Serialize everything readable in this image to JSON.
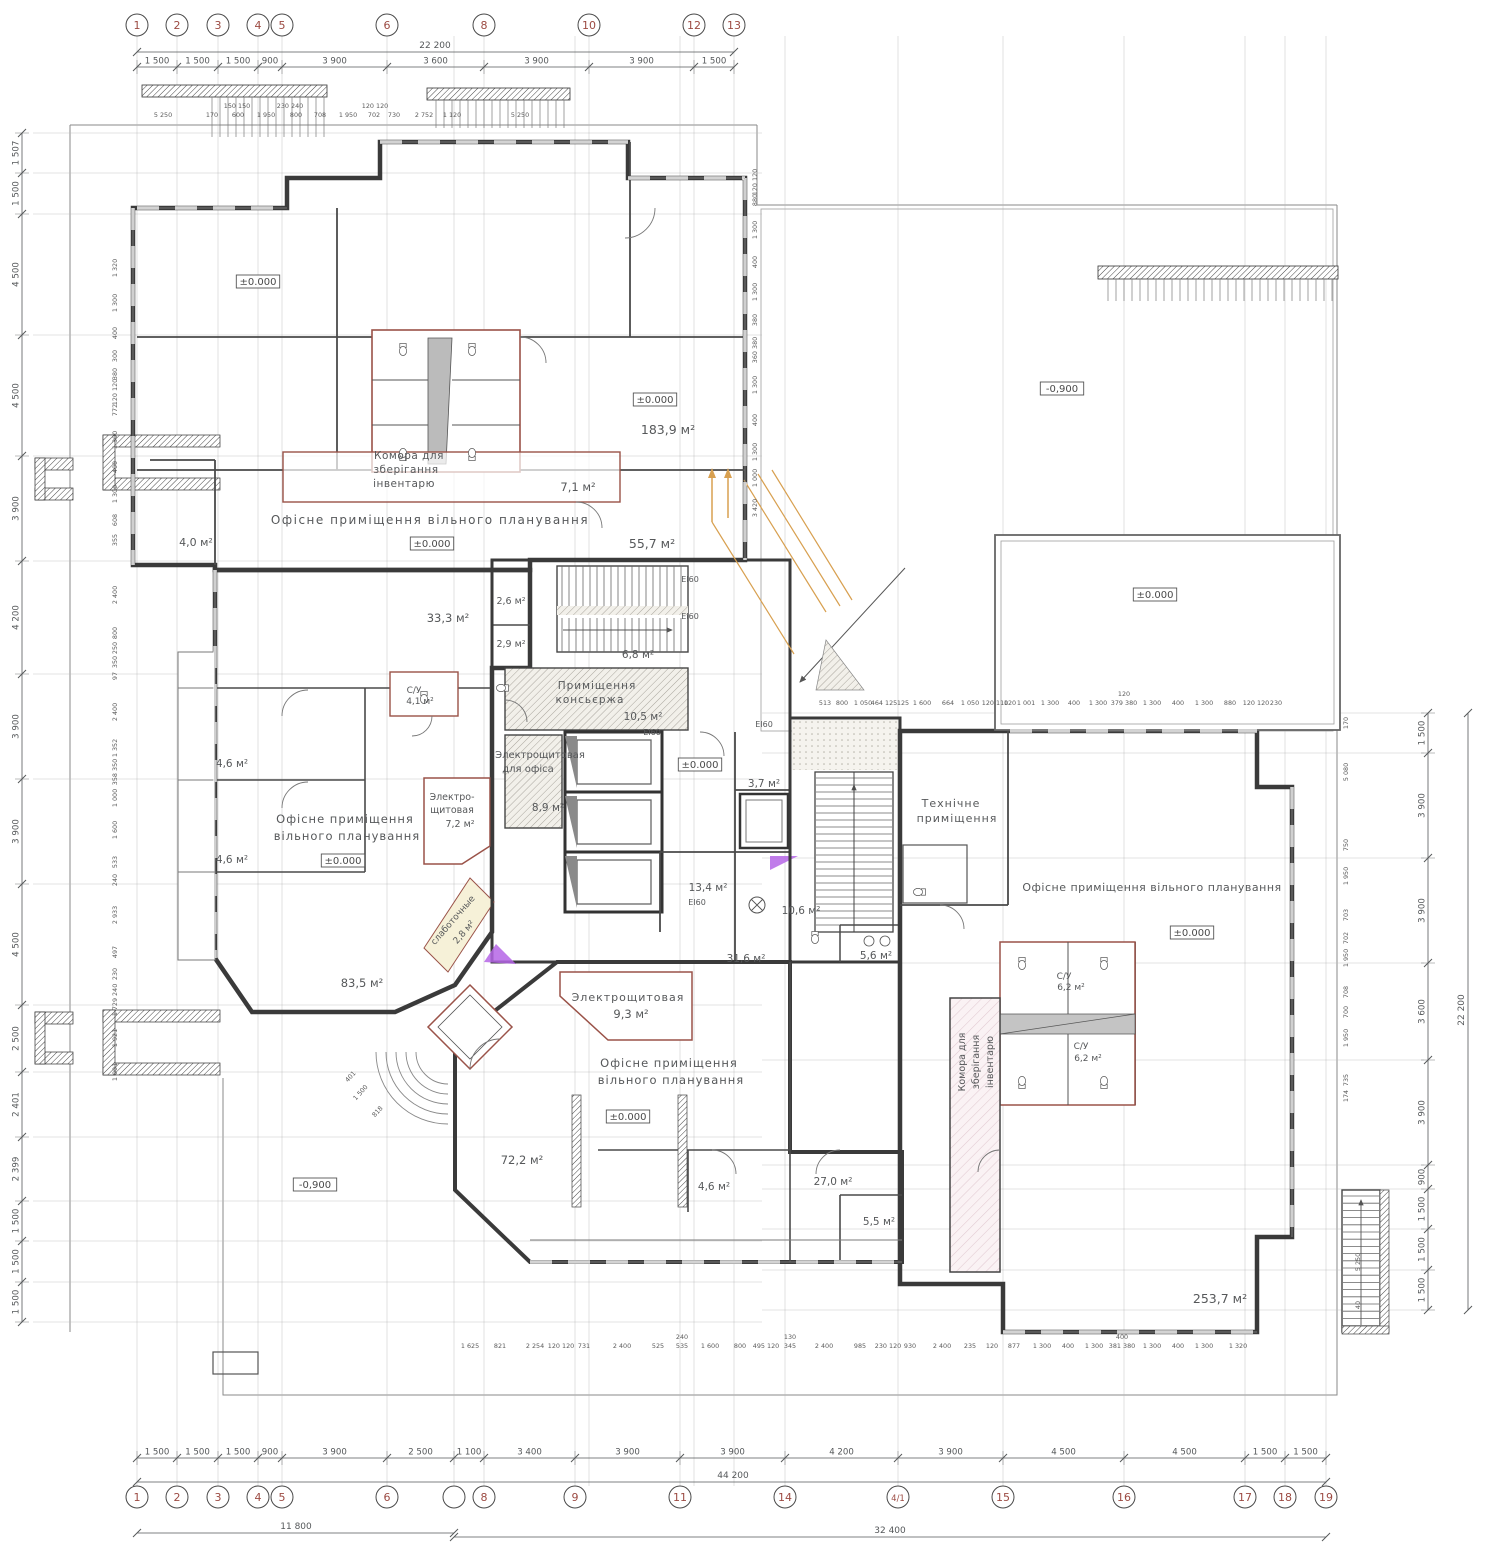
{
  "meta": {
    "title": "Ground floor plan — free-plan office building",
    "type": "architectural-floor-plan",
    "units": "mm"
  },
  "colors": {
    "wall": "#3a3a3a",
    "partition": "#9a5248",
    "dim": "#55585a",
    "tiny": "#5a5a5a",
    "axis_number": "#9c4a42",
    "mint": "#eef6f0",
    "cyan": "#ddf2f4",
    "lavender": "#eff0f9",
    "pink": "#faf2f4",
    "accent_orange": "#d8a050",
    "accent_purple": "#b565e6"
  },
  "dimensions": {
    "top_overall": "22 200",
    "bottom_overall": "44 200",
    "bottom_span_left": "11 800",
    "bottom_span_right": "32 400",
    "right_overall": "22 200"
  },
  "axes": {
    "top": {
      "cy": 25,
      "r": 11,
      "items": [
        [
          137,
          "1"
        ],
        [
          177,
          "2"
        ],
        [
          218,
          "3"
        ],
        [
          258,
          "4"
        ],
        [
          282,
          "5"
        ],
        [
          387,
          "6"
        ],
        [
          484,
          "8"
        ],
        [
          589,
          "10"
        ],
        [
          694,
          "12"
        ],
        [
          734,
          "13"
        ]
      ]
    },
    "bottom": {
      "cy": 1497,
      "r": 11,
      "items": [
        [
          137,
          "1"
        ],
        [
          177,
          "2"
        ],
        [
          218,
          "3"
        ],
        [
          258,
          "4"
        ],
        [
          282,
          "5"
        ],
        [
          387,
          "6"
        ],
        [
          454,
          ""
        ],
        [
          484,
          "8"
        ],
        [
          575,
          "9"
        ],
        [
          680,
          "11"
        ],
        [
          785,
          "14"
        ],
        [
          898,
          "4/1"
        ],
        [
          1003,
          "15"
        ],
        [
          1124,
          "16"
        ],
        [
          1245,
          "17"
        ],
        [
          1285,
          "18"
        ],
        [
          1326,
          "19"
        ]
      ]
    }
  },
  "grid": {
    "vx": [
      137,
      177,
      218,
      258,
      282,
      387,
      454,
      484,
      575,
      589,
      680,
      694,
      734,
      785,
      898,
      1003,
      1124,
      1245,
      1285,
      1326
    ],
    "hyl": [
      133,
      173,
      214,
      335,
      456,
      561,
      674,
      779,
      884,
      1005,
      1072,
      1137,
      1201,
      1241,
      1282,
      1322
    ],
    "hyr": [
      713,
      753,
      858,
      963,
      1060,
      1165,
      1189,
      1229,
      1270,
      1310
    ]
  },
  "chains": [
    {
      "name": "top-segments",
      "dir": "h",
      "pos": 67,
      "bounds": [
        137,
        177,
        218,
        258,
        282,
        387,
        484,
        589,
        694,
        734
      ],
      "labels": [
        "1 500",
        "1 500",
        "1 500",
        "900",
        "3 900",
        "3 600",
        "3 900",
        "3 900",
        "1 500"
      ]
    },
    {
      "name": "bottom-segments",
      "dir": "h",
      "pos": 1458,
      "bounds": [
        137,
        177,
        218,
        258,
        282,
        387,
        454,
        484,
        575,
        680,
        785,
        898,
        1003,
        1124,
        1245,
        1285,
        1326
      ],
      "labels": [
        "1 500",
        "1 500",
        "1 500",
        "900",
        "3 900",
        "2 500",
        "1 100",
        "3 400",
        "3 900",
        "3 900",
        "4 200",
        "3 900",
        "4 500",
        "4 500",
        "1 500",
        "1 500"
      ]
    },
    {
      "name": "left-segments",
      "dir": "v",
      "pos": 22,
      "bounds": [
        133,
        173,
        214,
        335,
        456,
        561,
        674,
        779,
        884,
        1005,
        1072,
        1137,
        1201,
        1241,
        1282,
        1322
      ],
      "labels": [
        "1 507",
        "1 500",
        "4 500",
        "4 500",
        "3 900",
        "4 200",
        "3 900",
        "3 900",
        "4 500",
        "2 500",
        "2 401",
        "2 399",
        "1 500",
        "1 500",
        "1 500"
      ]
    },
    {
      "name": "right-segments",
      "dir": "v",
      "pos": 1428,
      "bounds": [
        713,
        753,
        858,
        963,
        1060,
        1165,
        1189,
        1229,
        1270,
        1310
      ],
      "labels": [
        "1 500",
        "3 900",
        "3 900",
        "3 600",
        "3 900",
        "900",
        "1 500",
        "1 500",
        "1 500"
      ]
    }
  ],
  "overall_lines": [
    {
      "dir": "h",
      "pos": 52,
      "from": 137,
      "to": 734
    },
    {
      "dir": "h",
      "pos": 1482,
      "from": 137,
      "to": 1326
    },
    {
      "dir": "h",
      "pos": 1533,
      "from": 137,
      "to": 454
    },
    {
      "dir": "h",
      "pos": 1537,
      "from": 454,
      "to": 1326
    },
    {
      "dir": "v",
      "pos": 1468,
      "from": 713,
      "to": 1310
    }
  ],
  "tiny_dims": [
    [
      163,
      117,
      "5 250"
    ],
    [
      212,
      117,
      "170"
    ],
    [
      238,
      117,
      "600"
    ],
    [
      266,
      117,
      "1 950"
    ],
    [
      296,
      117,
      "800"
    ],
    [
      320,
      117,
      "708"
    ],
    [
      348,
      117,
      "1 950"
    ],
    [
      374,
      117,
      "702"
    ],
    [
      394,
      117,
      "730"
    ],
    [
      424,
      117,
      "2 752"
    ],
    [
      452,
      117,
      "1 120"
    ],
    [
      520,
      117,
      "5 250"
    ],
    [
      237,
      108,
      "150 150"
    ],
    [
      290,
      108,
      "230 240"
    ],
    [
      375,
      108,
      "120 120"
    ],
    [
      825,
      705,
      "513"
    ],
    [
      842,
      705,
      "800"
    ],
    [
      863,
      705,
      "1 050"
    ],
    [
      884,
      705,
      "464 125"
    ],
    [
      903,
      705,
      "125"
    ],
    [
      922,
      705,
      "1 600"
    ],
    [
      948,
      705,
      "664"
    ],
    [
      970,
      705,
      "1 050"
    ],
    [
      995,
      705,
      "120 110"
    ],
    [
      1010,
      705,
      "120"
    ],
    [
      1026,
      705,
      "1 001"
    ],
    [
      1050,
      705,
      "1 300"
    ],
    [
      1074,
      705,
      "400"
    ],
    [
      1098,
      705,
      "1 300"
    ],
    [
      1124,
      705,
      "379 380"
    ],
    [
      1152,
      705,
      "1 300"
    ],
    [
      1178,
      705,
      "400"
    ],
    [
      1204,
      705,
      "1 300"
    ],
    [
      1230,
      705,
      "880"
    ],
    [
      1256,
      705,
      "120 120"
    ],
    [
      1276,
      705,
      "230"
    ],
    [
      1124,
      696,
      "120"
    ],
    [
      470,
      1348,
      "1 625"
    ],
    [
      500,
      1348,
      "821"
    ],
    [
      535,
      1348,
      "2 254"
    ],
    [
      561,
      1348,
      "120 120"
    ],
    [
      584,
      1348,
      "731"
    ],
    [
      622,
      1348,
      "2 400"
    ],
    [
      658,
      1348,
      "525"
    ],
    [
      682,
      1348,
      "535"
    ],
    [
      682,
      1339,
      "240"
    ],
    [
      710,
      1348,
      "1 600"
    ],
    [
      740,
      1348,
      "800"
    ],
    [
      766,
      1348,
      "495 120"
    ],
    [
      790,
      1348,
      "345"
    ],
    [
      790,
      1339,
      "130"
    ],
    [
      824,
      1348,
      "2 400"
    ],
    [
      860,
      1348,
      "985"
    ],
    [
      888,
      1348,
      "230 120"
    ],
    [
      910,
      1348,
      "930"
    ],
    [
      942,
      1348,
      "2 400"
    ],
    [
      970,
      1348,
      "235"
    ],
    [
      992,
      1348,
      "120"
    ],
    [
      1014,
      1348,
      "877"
    ],
    [
      1042,
      1348,
      "1 300"
    ],
    [
      1068,
      1348,
      "400"
    ],
    [
      1094,
      1348,
      "1 300"
    ],
    [
      1122,
      1348,
      "381 380"
    ],
    [
      1122,
      1339,
      "400"
    ],
    [
      1152,
      1348,
      "1 300"
    ],
    [
      1178,
      1348,
      "400"
    ],
    [
      1204,
      1348,
      "1 300"
    ],
    [
      1238,
      1348,
      "1 320"
    ],
    [
      117,
      268,
      "1 320",
      -90
    ],
    [
      117,
      303,
      "1 300",
      -90
    ],
    [
      117,
      333,
      "400",
      -90
    ],
    [
      117,
      356,
      "300",
      -90
    ],
    [
      117,
      374,
      "380",
      -90
    ],
    [
      117,
      392,
      "120 120",
      -90
    ],
    [
      117,
      410,
      "772",
      -90
    ],
    [
      117,
      440,
      "1 300",
      -90
    ],
    [
      117,
      467,
      "400",
      -90
    ],
    [
      117,
      494,
      "1 300",
      -90
    ],
    [
      117,
      520,
      "608",
      -90
    ],
    [
      117,
      540,
      "355",
      -90
    ],
    [
      117,
      595,
      "2 400",
      -90
    ],
    [
      117,
      633,
      "800",
      -90
    ],
    [
      117,
      648,
      "250",
      -90
    ],
    [
      117,
      662,
      "350",
      -90
    ],
    [
      117,
      676,
      "97",
      -90
    ],
    [
      117,
      712,
      "2 400",
      -90
    ],
    [
      117,
      748,
      "1 352",
      -90
    ],
    [
      117,
      772,
      "358 350",
      -90
    ],
    [
      117,
      798,
      "1 000",
      -90
    ],
    [
      117,
      830,
      "1 600",
      -90
    ],
    [
      117,
      862,
      "533",
      -90
    ],
    [
      117,
      880,
      "240",
      -90
    ],
    [
      117,
      915,
      "2 933",
      -90
    ],
    [
      117,
      952,
      "497",
      -90
    ],
    [
      117,
      974,
      "230",
      -90
    ],
    [
      117,
      1000,
      "1 729 240",
      -90
    ],
    [
      117,
      1038,
      "1 921",
      -90
    ],
    [
      117,
      1072,
      "1 001",
      -90
    ],
    [
      757,
      182,
      "120 120",
      -90
    ],
    [
      757,
      200,
      "880",
      -90
    ],
    [
      757,
      230,
      "1 300",
      -90
    ],
    [
      757,
      262,
      "400",
      -90
    ],
    [
      757,
      292,
      "1 300",
      -90
    ],
    [
      757,
      320,
      "380",
      -90
    ],
    [
      757,
      350,
      "360 380",
      -90
    ],
    [
      757,
      385,
      "1 300",
      -90
    ],
    [
      757,
      420,
      "400",
      -90
    ],
    [
      757,
      452,
      "1 300",
      -90
    ],
    [
      757,
      478,
      "1 000",
      -90
    ],
    [
      757,
      508,
      "3 420",
      -90
    ],
    [
      1348,
      723,
      "170",
      -90
    ],
    [
      1348,
      772,
      "5 080",
      -90
    ],
    [
      1348,
      845,
      "750",
      -90
    ],
    [
      1348,
      876,
      "1 950",
      -90
    ],
    [
      1348,
      915,
      "703",
      -90
    ],
    [
      1348,
      938,
      "702",
      -90
    ],
    [
      1348,
      958,
      "1 950",
      -90
    ],
    [
      1348,
      992,
      "708",
      -90
    ],
    [
      1348,
      1012,
      "700",
      -90
    ],
    [
      1348,
      1038,
      "1 950",
      -90
    ],
    [
      1348,
      1080,
      "735",
      -90
    ],
    [
      1348,
      1096,
      "174",
      -90
    ],
    [
      1360,
      1262,
      "5 250",
      -90
    ],
    [
      1360,
      1305,
      "40",
      -90
    ],
    [
      352,
      1078,
      "401",
      -48
    ],
    [
      362,
      1094,
      "1 500",
      -48
    ],
    [
      379,
      1113,
      "818",
      -48
    ]
  ],
  "room_labels": [
    [
      430,
      524,
      "Офісне приміщення вільного планування",
      12,
      1.5,
      0
    ],
    [
      409,
      459,
      "Комора для",
      10.5,
      0.5,
      0
    ],
    [
      406,
      473,
      "зберігання",
      10.5,
      0.5,
      0
    ],
    [
      404,
      487,
      "інвентарю",
      10.5,
      0.5,
      0
    ],
    [
      578,
      491,
      "7,1 м²",
      11.5,
      0,
      0
    ],
    [
      668,
      434,
      "183,9 м²",
      12.5,
      0,
      0
    ],
    [
      652,
      548,
      "55,7 м²",
      12.5,
      0,
      0
    ],
    [
      196,
      546,
      "4,0 м²",
      11,
      0,
      0
    ],
    [
      448,
      622,
      "33,3 м²",
      11.5,
      0,
      0
    ],
    [
      511,
      604,
      "2,6 м²",
      9.5,
      0,
      0
    ],
    [
      511,
      647,
      "2,9 м²",
      9.5,
      0,
      0
    ],
    [
      638,
      658,
      "6,8 м²",
      10.5,
      0,
      0
    ],
    [
      597,
      689,
      "Приміщення",
      10.5,
      1,
      0
    ],
    [
      590,
      703,
      "консьєржа",
      10.5,
      1,
      0
    ],
    [
      643,
      720,
      "10,5 м²",
      10.5,
      0,
      0
    ],
    [
      540,
      758,
      "Электрощитовая",
      10,
      0,
      0
    ],
    [
      528,
      772,
      "для офіса",
      10,
      0,
      0
    ],
    [
      548,
      811,
      "8,9 м²",
      10.5,
      0,
      0
    ],
    [
      414,
      693,
      "С/У",
      9,
      0,
      0
    ],
    [
      420,
      704,
      "4,1 м²",
      9,
      0,
      0
    ],
    [
      345,
      823,
      "Офісне приміщення",
      11.5,
      1,
      0
    ],
    [
      347,
      840,
      "вільного планування",
      11.5,
      1,
      0
    ],
    [
      232,
      767,
      "4,6 м²",
      10.5,
      0,
      0
    ],
    [
      232,
      863,
      "4,6 м²",
      10.5,
      0,
      0
    ],
    [
      362,
      987,
      "83,5 м²",
      11.5,
      0,
      0
    ],
    [
      452,
      800,
      "Электро-",
      9.5,
      0,
      0
    ],
    [
      452,
      813,
      "щитовая",
      9.5,
      0,
      0
    ],
    [
      460,
      827,
      "7,2 м²",
      9.5,
      0,
      0
    ],
    [
      455,
      922,
      "слаботочные",
      9,
      0,
      -49
    ],
    [
      466,
      934,
      "2,8 м²",
      9,
      0,
      -49
    ],
    [
      764,
      787,
      "3,7 м²",
      10.5,
      0,
      0
    ],
    [
      708,
      891,
      "13,4 м²",
      10.5,
      0,
      0
    ],
    [
      801,
      914,
      "10,6 м²",
      10.5,
      0,
      0
    ],
    [
      746,
      962,
      "31,6 м²",
      10.5,
      0,
      0
    ],
    [
      876,
      959,
      "5,6 м²",
      10.5,
      0,
      0
    ],
    [
      951,
      807,
      "Технічне",
      11,
      1,
      0
    ],
    [
      957,
      822,
      "приміщення",
      11,
      1,
      0
    ],
    [
      1152,
      891,
      "Офісне приміщення вільного планування",
      11,
      0.5,
      0
    ],
    [
      1064,
      979,
      "С/У",
      9,
      0,
      0
    ],
    [
      1071,
      990,
      "6,2 м²",
      9,
      0,
      0
    ],
    [
      1081,
      1049,
      "С/У",
      9,
      0,
      0
    ],
    [
      1088,
      1061,
      "6,2 м²",
      9,
      0,
      0
    ],
    [
      965,
      1062,
      "Комора для",
      9.5,
      0,
      -90
    ],
    [
      979,
      1062,
      "зберігання",
      9.5,
      0,
      -90
    ],
    [
      993,
      1062,
      "інвентарю",
      9.5,
      0,
      -90
    ],
    [
      1220,
      1303,
      "253,7 м²",
      12.5,
      0,
      0
    ],
    [
      628,
      1001,
      "Электрощитовая",
      11,
      1,
      0
    ],
    [
      631,
      1018,
      "9,3 м²",
      11.5,
      0,
      0
    ],
    [
      669,
      1067,
      "Офісне приміщення",
      11.5,
      1,
      0
    ],
    [
      671,
      1084,
      "вільного планування",
      11.5,
      1,
      0
    ],
    [
      522,
      1164,
      "72,2 м²",
      11.5,
      0,
      0
    ],
    [
      714,
      1190,
      "4,6 м²",
      10.5,
      0,
      0
    ],
    [
      833,
      1185,
      "27,0 м²",
      10.5,
      0,
      0
    ],
    [
      879,
      1225,
      "5,5 м²",
      10.5,
      0,
      0
    ]
  ],
  "fire_rating_text": "ЕІ60",
  "fire_labels": [
    [
      690,
      582
    ],
    [
      690,
      619
    ],
    [
      652,
      735
    ],
    [
      764,
      727
    ],
    [
      697,
      905
    ]
  ],
  "level_marks": [
    [
      258,
      285,
      "±0.000"
    ],
    [
      655,
      403,
      "±0.000"
    ],
    [
      432,
      547,
      "±0.000"
    ],
    [
      343,
      864,
      "±0.000"
    ],
    [
      700,
      768,
      "±0.000"
    ],
    [
      628,
      1120,
      "±0.000"
    ],
    [
      1192,
      936,
      "±0.000"
    ],
    [
      1155,
      598,
      "±0.000"
    ],
    [
      1062,
      392,
      "-0,900"
    ],
    [
      315,
      1188,
      "-0,900"
    ]
  ]
}
